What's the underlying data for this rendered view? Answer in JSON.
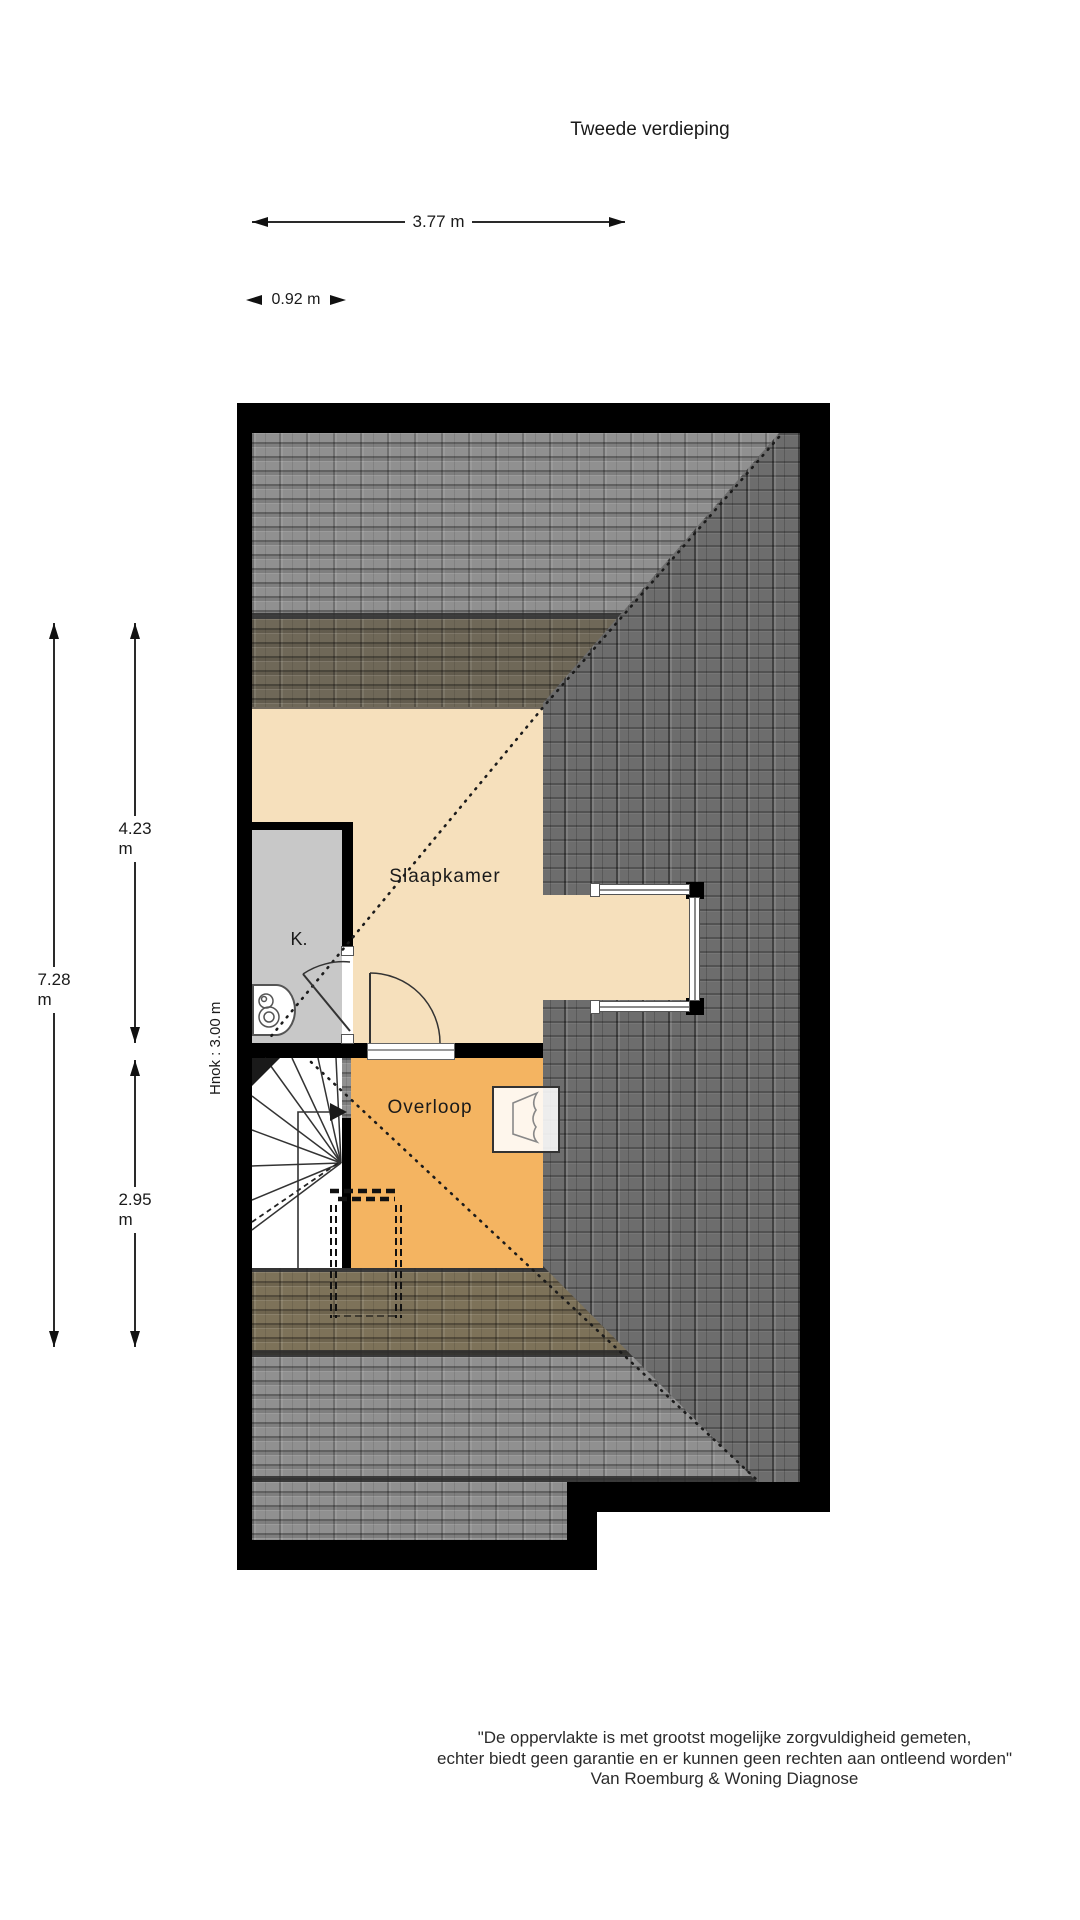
{
  "title": "Tweede verdieping",
  "dimensions": {
    "top_width": "3.77 m",
    "stair_width": "0.92 m",
    "total_depth": "7.28 m",
    "bedroom_depth": "4.23 m",
    "landing_depth": "2.95 m",
    "knee_wall_height": "Hnok : 3.00 m"
  },
  "rooms": {
    "bedroom": "Slaapkamer",
    "closet": "K.",
    "landing": "Overloop"
  },
  "disclaimer": {
    "lines": [
      "\"De oppervlakte is met grootst mogelijke zorgvuldigheid gemeten,",
      "echter biedt geen garantie en er kunnen geen rechten aan ontleend worden\"",
      "Van Roemburg & Woning Diagnose"
    ]
  },
  "colors": {
    "wall": "#000000",
    "bedroom_floor": "#f6e0bc",
    "landing_floor": "#f4b461",
    "closet_floor": "#c8c8c8",
    "roof_tiles_light": "#909090",
    "roof_tiles_dark": "#6d6d6d",
    "roof_tiles_olive": "#6f6858",
    "roof_tiles_brown": "#7d7259"
  }
}
